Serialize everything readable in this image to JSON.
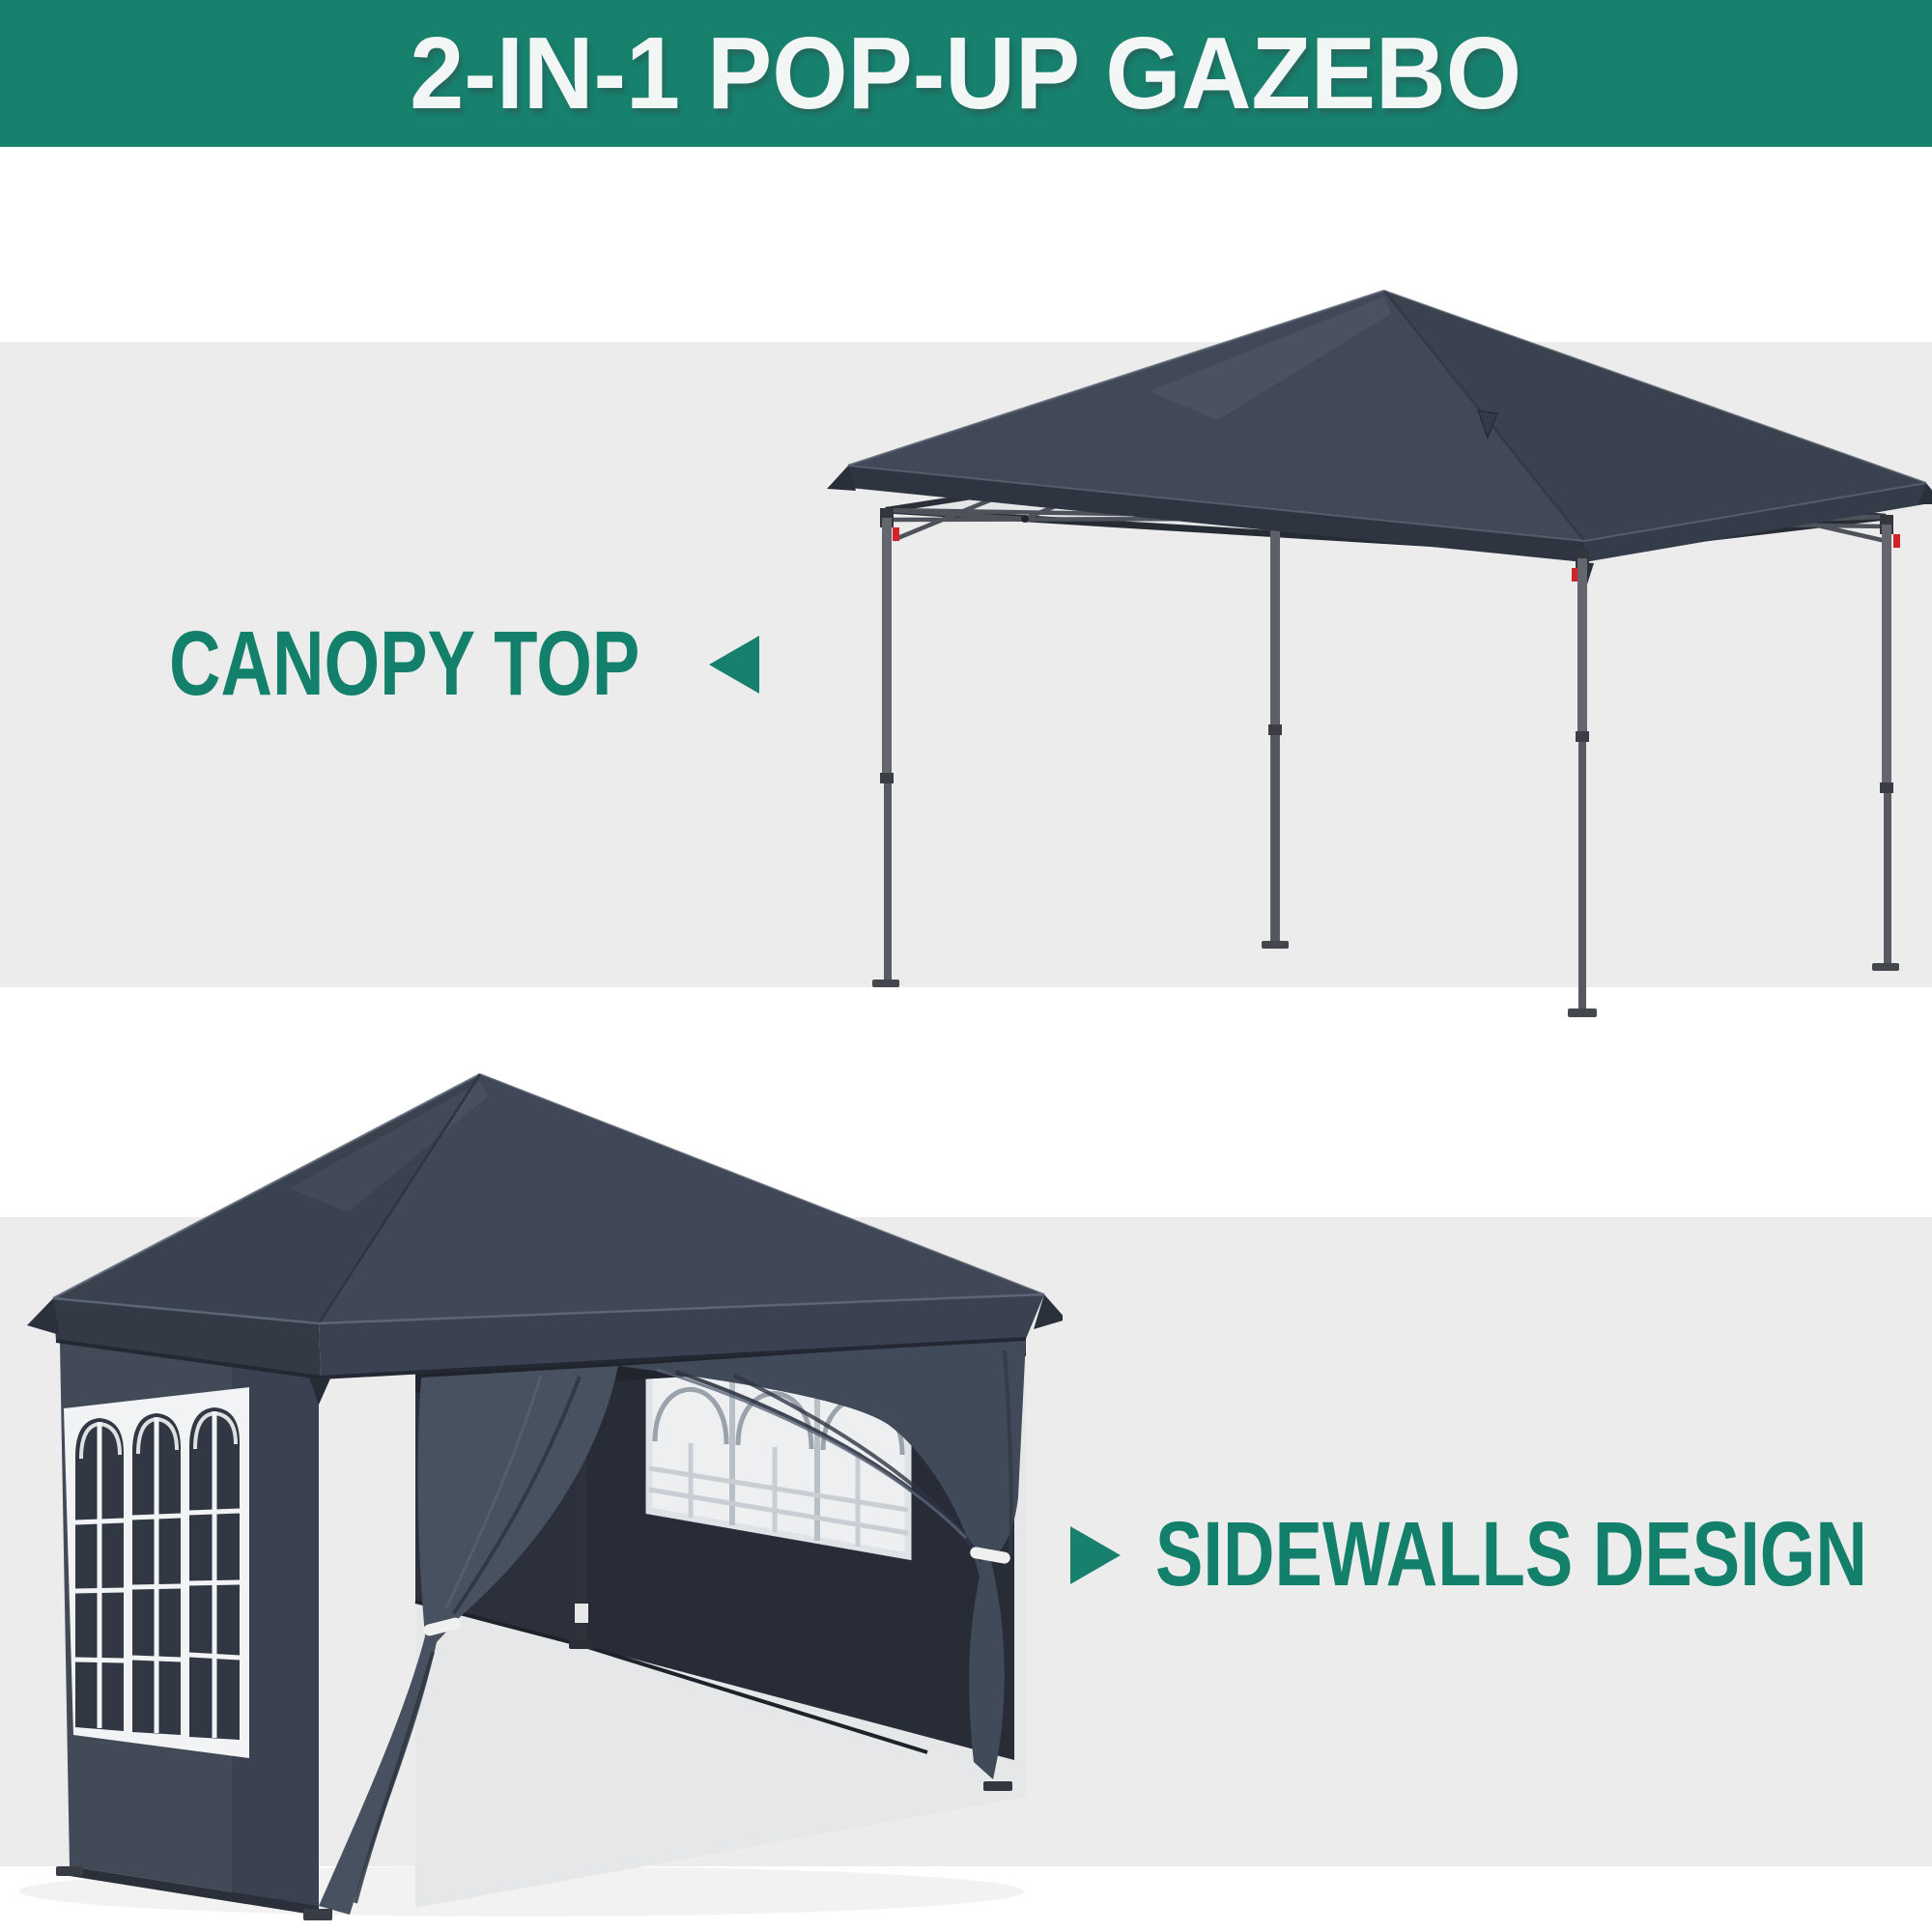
{
  "banner": {
    "title": "2-IN-1 POP-UP GAZEBO"
  },
  "features": [
    {
      "id": "canopy-top",
      "label": "CANOPY TOP",
      "pointer": "arrow-left-icon"
    },
    {
      "id": "sidewalls-design",
      "label": "SIDEWALLS DESIGN",
      "pointer": "arrow-right-icon"
    }
  ],
  "palette": {
    "teal": "#17816E",
    "label-teal": "#12806B",
    "banner-text": "#F2F7F6",
    "band": "#ECECEC",
    "canopy": "#3E4654",
    "canopy-light": "#434B59",
    "canopy-dark": "#3A4250",
    "valance": "#2F3642",
    "under-canopy": "#E4E5E7",
    "truss": "#4D525B",
    "frame-dark": "#262B34",
    "leg": "#63676D",
    "leg-dark": "#33373D",
    "accent-red": "#D2232A",
    "window-frame": "#F2F3F4",
    "pane-dark": "#313743",
    "pane-light": "#EDEFF1",
    "curtain": "#48515F",
    "interior": "#272C37"
  }
}
